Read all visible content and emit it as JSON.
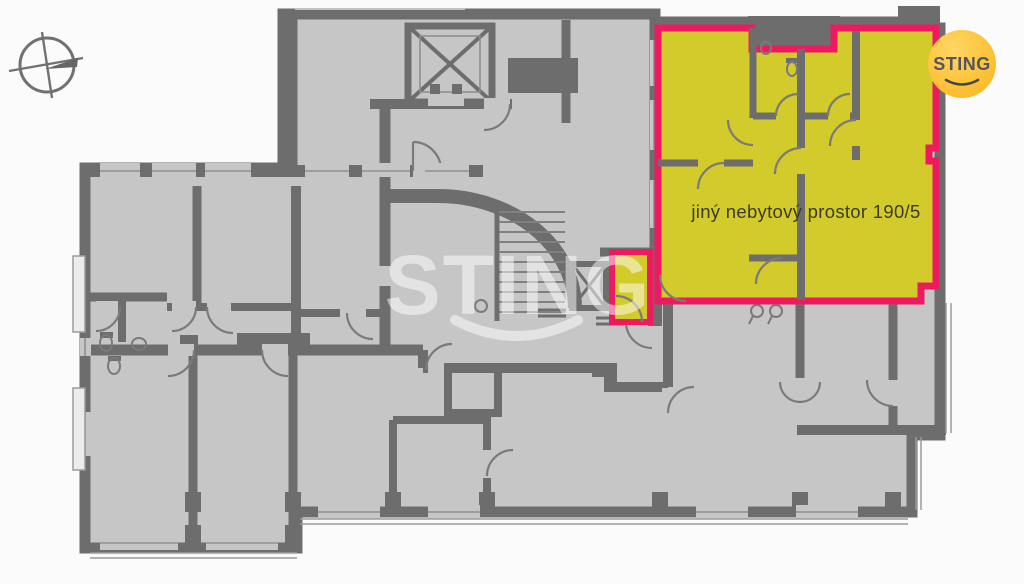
{
  "floorplan": {
    "unit_label": "jiný nebytový prostor 190/5",
    "watermark": "STING",
    "logo_text": "STING"
  },
  "colors": {
    "background": "#fbfbfb",
    "floor": "#c6c6c6",
    "wall": "#6d6d6d",
    "wall_light": "#8f8f8f",
    "highlight_fill": "#d3ca2b",
    "highlight_border": "#ee1a5f",
    "logo_circle": "#fdbf2e",
    "logo_text_color": "#55555a",
    "label_color": "#3b3b2e",
    "watermark_color": "rgba(255,255,255,0.5)"
  }
}
